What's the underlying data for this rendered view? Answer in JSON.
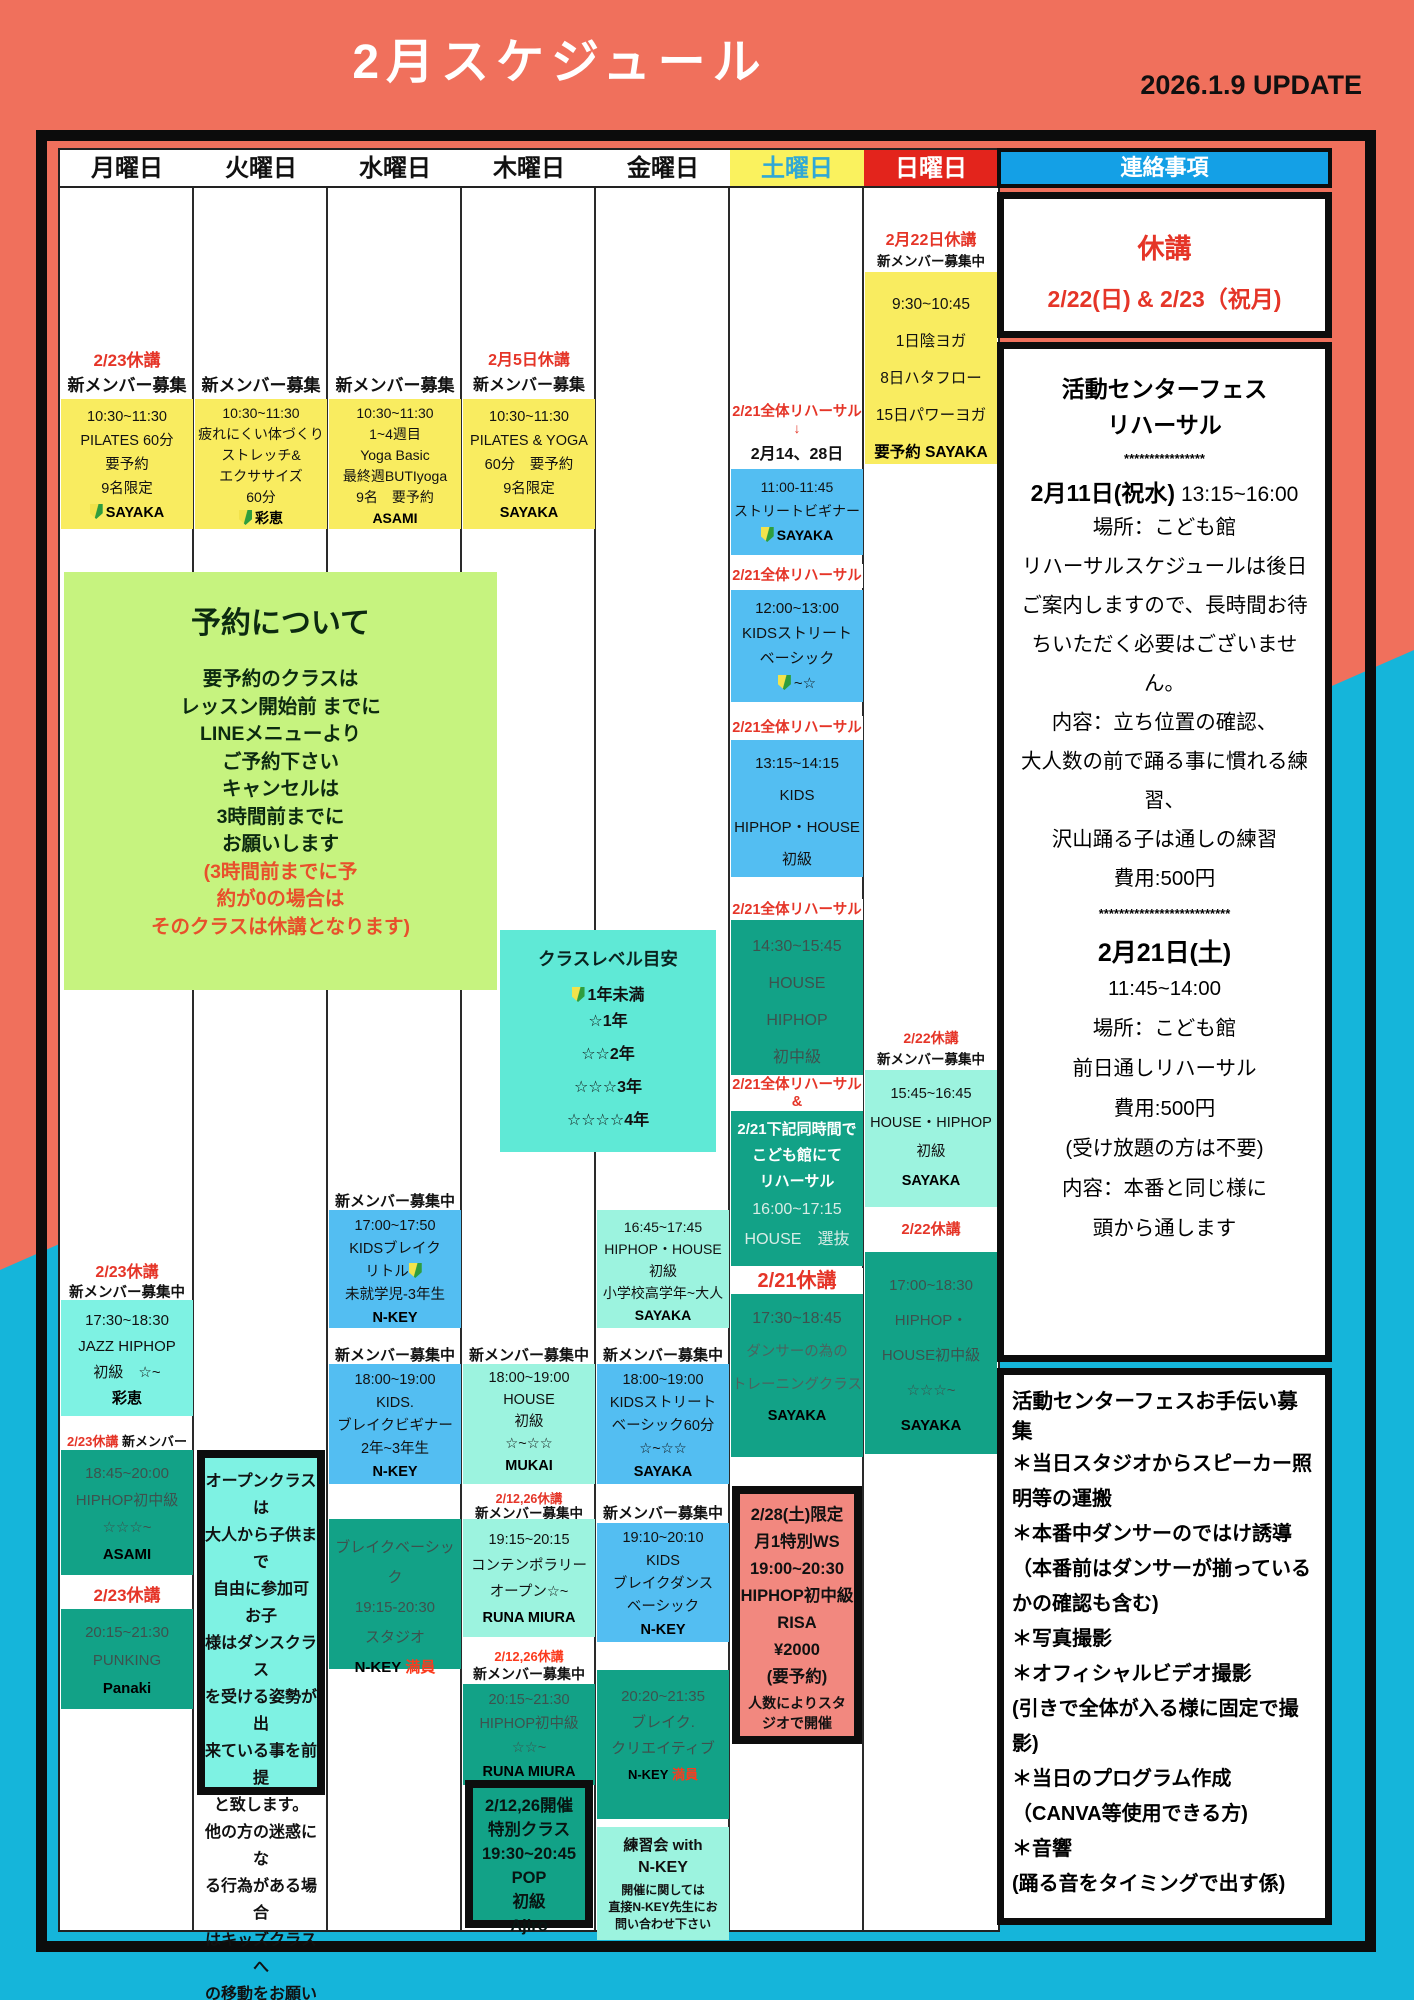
{
  "header": {
    "title": "2月スケジュール",
    "update": "2026.1.9 UPDATE"
  },
  "days": [
    "月曜日",
    "火曜日",
    "水曜日",
    "木曜日",
    "金曜日",
    "土曜日",
    "日曜日"
  ],
  "mon": {
    "closed1": "2/23休講",
    "recruit1": "新メンバー募集中",
    "morning": {
      "text": "10:30~11:30\nPILATES 60分\n要予約\n9名限定",
      "teacher": "SAYAKA"
    },
    "closed2": "2/23休講",
    "recruit2": "新メンバー募集中",
    "jazz": {
      "text": "17:30~18:30\nJAZZ HIPHOP\n初級　☆~",
      "teacher": "彩恵"
    },
    "closed3": "2/23休講",
    "recruit3": "新メンバー募集",
    "hiphop": {
      "text": "18:45~20:00\nHIPHOP初中級\n☆☆☆~",
      "teacher": "ASAMI"
    },
    "closed4": "2/23休講",
    "punking": {
      "text": "20:15~21:30\nPUNKING",
      "teacher": "Panaki"
    }
  },
  "tue": {
    "recruit": "新メンバー募集中",
    "morning": {
      "text": "10:30~11:30\n疲れにくい体づくり\nストレッチ&\nエクササイズ\n60分",
      "teacher": "彩恵"
    },
    "open_note": "オープンクラスは\n大人から子供まで\n自由に参加可 お子\n様はダンスクラス\nを受ける姿勢が出\n来ている事を前提\nと致します。\n他の方の迷惑にな\nる行為がある場合\nはキッズクラスへ\nの移動をお願いす\nる事もあります"
  },
  "wed": {
    "recruit": "新メンバー募集中",
    "morning": {
      "text": "10:30~11:30\n1~4週目\nYoga Basic\n最終週BUTIyoga\n9名　要予約",
      "teacher": "ASAMI"
    },
    "recruit1": "新メンバー募集中",
    "kids_break": {
      "text": "17:00~17:50\nKIDSブレイク",
      "little": "リトル",
      "grade": "未就学児-3年生",
      "teacher": "N-KEY"
    },
    "recruit2": "新メンバー募集中",
    "break_beginner": {
      "text": "18:00~19:00\nKIDS.\nブレイクビギナー\n2年~3年生",
      "teacher": "N-KEY"
    },
    "break_basic": {
      "text": "ブレイクベーシック\n19:15-20:30\nスタジオ",
      "teacher": "N-KEY",
      "full": "満員"
    }
  },
  "thu": {
    "closed1": "2月5日休講",
    "recruit1": "新メンバー募集中!",
    "morning": {
      "text": "10:30~11:30\nPILATES & YOGA\n60分　要予約\n9名限定",
      "teacher": "SAYAKA"
    },
    "recruit2": "新メンバー募集中",
    "house": {
      "text": "18:00~19:00\nHOUSE\n初級\n☆~☆☆",
      "teacher": "MUKAI"
    },
    "closed2": "2/12,26休講",
    "recruit3": "新メンバー募集中",
    "contemporary": {
      "text": "19:15~20:15\nコンテンポラリー\nオープン☆~",
      "teacher": "RUNA MIURA"
    },
    "closed3": "2/12,26休講",
    "recruit4": "新メンバー募集中",
    "hiphop": {
      "text": "20:15~21:30\nHIPHOP初中級\n☆☆~",
      "teacher": "RUNA MIURA"
    },
    "pop_special": "2/12,26開催\n特別クラス\n19:30~20:45\nPOP\n初級\nAjiro"
  },
  "fri": {
    "hiphop_house": {
      "text": "16:45~17:45\nHIPHOP・HOUSE\n初級\n小学校高学年~大人",
      "teacher": "SAYAKA"
    },
    "recruit1": "新メンバー募集中",
    "street": {
      "text": "18:00~19:00\nKIDSストリート\nベーシック60分\n☆~☆☆",
      "teacher": "SAYAKA"
    },
    "recruit2": "新メンバー募集中",
    "breakdance": {
      "text": "19:10~20:10\nKIDS\nブレイクダンス\nベーシック",
      "teacher": "N-KEY"
    },
    "creative": {
      "text": "20:20~21:35\nブレイク.\nクリエイティブ",
      "teacher": "N-KEY",
      "full": "満員"
    },
    "practice": {
      "line1": "練習会 with",
      "line2": "N-KEY",
      "note": "開催に関しては\n直接N-KEY先生にお\n問い合わせ下さい"
    }
  },
  "sat": {
    "rh_label": "2/21全体リハーサル",
    "rh_arrow": "↓",
    "rh_dates": "2月14、28日",
    "street_beginner": {
      "text": "11:00-11:45\nストリートビギナー",
      "teacher": "SAYAKA"
    },
    "rh1": "2/21全体リハーサル",
    "kids_street": {
      "text": "12:00~13:00\nKIDSストリート\nベーシック",
      "level": "~☆"
    },
    "rh2": "2/21全体リハーサル",
    "kids_hiphop": "13:15~14:15\nKIDS\nHIPHOP・HOUSE\n初級",
    "rh3": "2/21全体リハーサル",
    "house_hiphop": "14:30~15:45\nHOUSE\nHIPHOP\n初中級",
    "rh4": "2/21全体リハーサル",
    "rh4_amp": "&",
    "kodomokan": {
      "head": "2/21下記同時間で\nこども館にて\nリハーサル",
      "body": "16:00~17:15\nHOUSE　選抜"
    },
    "closed": "2/21休講",
    "training": {
      "time": "17:30~18:45",
      "body": "ダンサーの為の\nトレーニングクラス",
      "teacher": "SAYAKA"
    },
    "ws": {
      "main": "2/28(土)限定\n月1特別WS\n19:00~20:30\nHIPHOP初中級\nRISA\n¥2000\n(要予約)",
      "note": "人数によりスタ\nジオで開催"
    }
  },
  "sun": {
    "closed1": "2月22日休講",
    "recruit1": "新メンバー募集中",
    "yoga": {
      "text": "9:30~10:45\n1日陰ヨガ\n8日ハタフロー\n15日パワーヨガ",
      "req": "要予約 SAYAKA"
    },
    "closed2": "2/22休講",
    "recruit2": "新メンバー募集中",
    "house_hiphop": {
      "text": "15:45~16:45\nHOUSE・HIPHOP\n初級",
      "teacher": "SAYAKA"
    },
    "closed3": "2/22休講",
    "hiphop_house": {
      "text": "17:00~18:30\nHIPHOP・\nHOUSE初中級\n☆☆☆~",
      "teacher": "SAYAKA"
    }
  },
  "booking": {
    "title": "予約について",
    "body": "要予約のクラスは\nレッスン開始前 までに\nLINEメニューより\nご予約下さい\nキャンセルは\n3時間前までに\nお願いします",
    "warning": "(3時間前までに予\n約が0の場合は\nそのクラスは休講となります)"
  },
  "levels": {
    "title": "クラスレベル目安",
    "first": "1年未満",
    "rows": "☆1年\n☆☆2年\n☆☆☆3年\n☆☆☆☆4年"
  },
  "contact": {
    "header": "連絡事項",
    "closure": {
      "line1": "休講",
      "line2": "2/22(日) & 2/23（祝月)"
    },
    "fes": {
      "title": "活動センターフェス\nリハーサル",
      "stars1": "****************",
      "date1": "2月11日(祝水)",
      "time1": " 13:15~16:00",
      "body1": "場所：こども館\nリハーサルスケジュールは後日ご案内しますので、長時間お待ちいただく必要はございません。\n内容：立ち位置の確認、\n大人数の前で踊る事に慣れる練習、\n沢山踊る子は通しの練習\n費用:500円",
      "stars2": "**************************",
      "date2": "2月21日(土)",
      "body2": "11:45~14:00\n場所：こども館\n前日通しリハーサル\n費用:500円\n(受け放題の方は不要)\n内容：本番と同じ様に\n頭から通します"
    },
    "help": {
      "title": "活動センターフェスお手伝い募集",
      "items": "＊当日スタジオからスピーカー照明等の運搬\n＊本番中ダンサーのではけ誘導\n（本番前はダンサーが揃っているかの確認も含む)\n＊写真撮影\n＊オフィシャルビデオ撮影\n(引きで全体が入る様に固定で撮影)\n＊当日のプログラム作成\n（CANVA等使用できる方)\n＊音響\n(踊る音をタイミングで出す係)"
    }
  }
}
